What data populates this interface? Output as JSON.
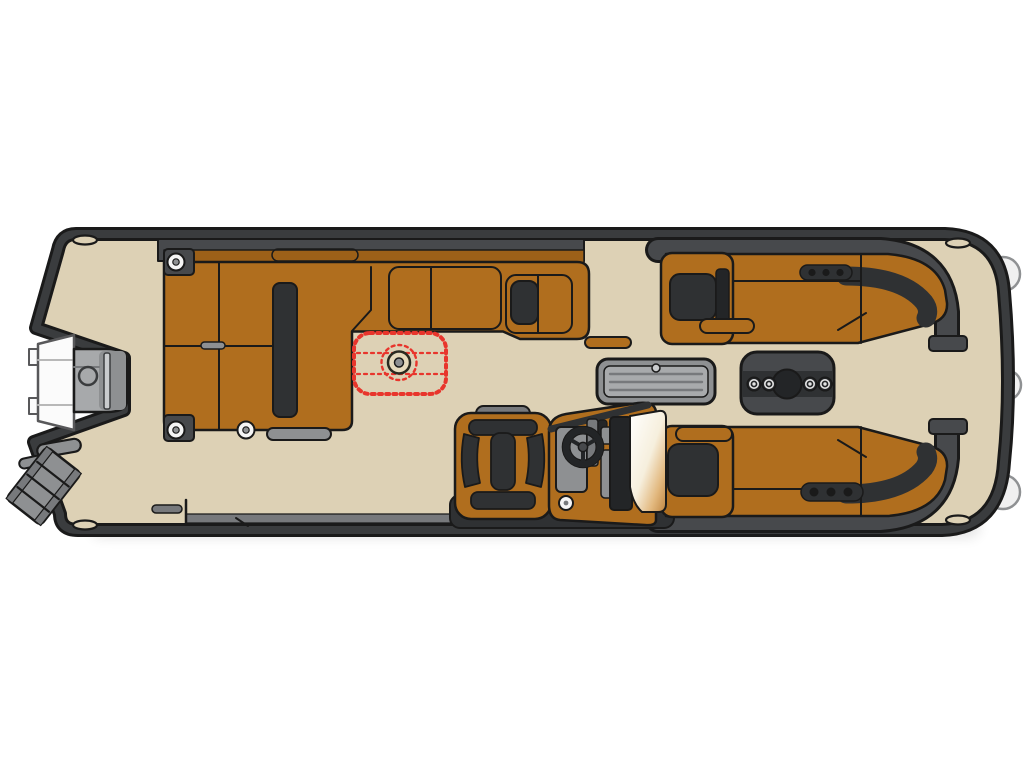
{
  "diagram": {
    "type": "pontoon-boat-floorplan",
    "aria_label": "Pontoon boat floor plan, top-down view",
    "orientation": {
      "stern": "left",
      "bow": "right"
    }
  },
  "colors": {
    "background": "#ffffff",
    "deck": "#ddd1b5",
    "edge": "#1a1a1a",
    "rim": "#3a3c3e",
    "band": "#47494c",
    "inset": "#2f3133",
    "dark": "#232527",
    "seat": "#b06e1e",
    "seat_dark": "#9c6018",
    "hw": "#8e9092",
    "hw_dark": "#77797c",
    "hw_light": "#c9cbcd",
    "hatch": "#a8aaac",
    "motor_gray": "#a7a9ab",
    "white": "#f5f5f5",
    "red": "#e8352c",
    "marker_base": "#e6dabc",
    "ws1": "#ffffff",
    "ws2": "#f6efdd",
    "ws3": "#e2b87e",
    "ws4": "#bf8540"
  },
  "components": [
    {
      "name": "outboard-motor",
      "label": "outboard motor"
    },
    {
      "name": "boarding-ladder",
      "label": "boarding ladder"
    },
    {
      "name": "stern-lounge",
      "label": "stern wrap-around lounge"
    },
    {
      "name": "table-mount-marker",
      "label": "dashed table position marker"
    },
    {
      "name": "storage-hatch",
      "label": "slatted deck hatch"
    },
    {
      "name": "cupholder-table",
      "label": "cup-holder table"
    },
    {
      "name": "helm-station",
      "label": "helm console and captain chair"
    },
    {
      "name": "steering-wheel",
      "label": "steering wheel"
    },
    {
      "name": "windshield",
      "label": "helm windshield"
    },
    {
      "name": "bow-lounge-top",
      "label": "bow lounge, top side"
    },
    {
      "name": "bow-lounge-bottom",
      "label": "bow lounge, bottom side"
    },
    {
      "name": "mooring-cleat",
      "label": "cleat"
    },
    {
      "name": "fender-bumper",
      "label": "fender"
    },
    {
      "name": "speaker",
      "label": "deck speaker"
    },
    {
      "name": "side-gate",
      "label": "boarding gate"
    }
  ]
}
